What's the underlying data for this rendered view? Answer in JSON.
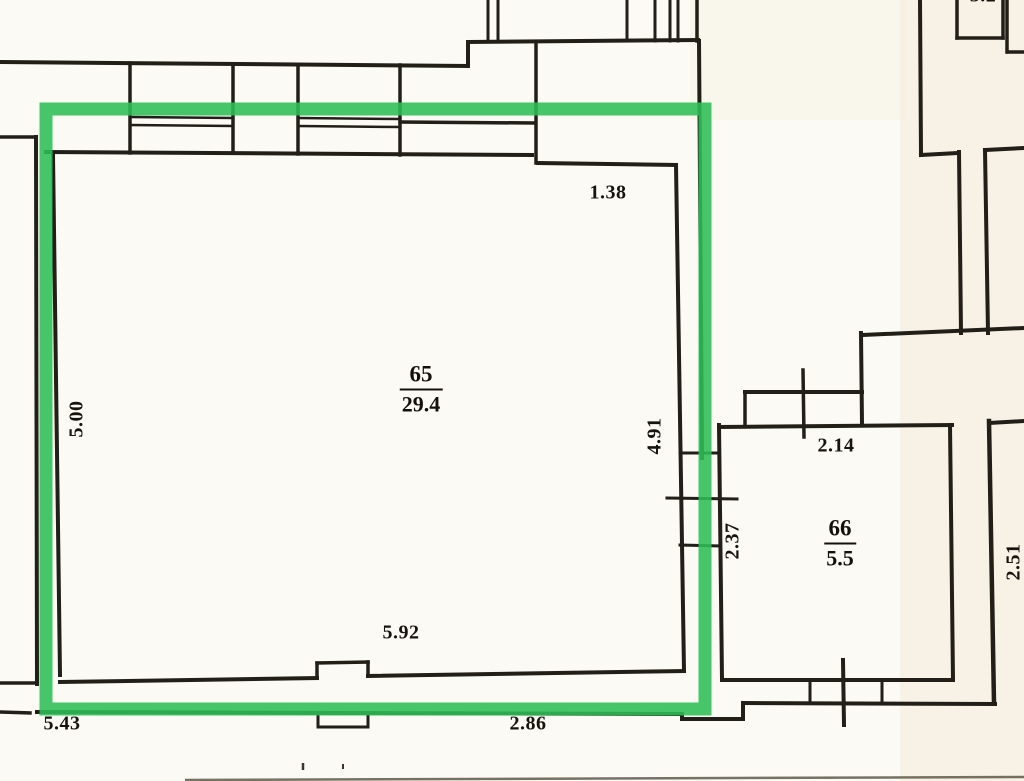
{
  "plan": {
    "kind": "scanned apartment floor plan with green highlight box",
    "highlight_color": "#2cbe55",
    "line_color": "#221f18",
    "paper_color": "#fbfaf4"
  },
  "rooms": [
    {
      "number": "65",
      "area": "29.4"
    },
    {
      "number": "66",
      "area": "5.5"
    }
  ],
  "dimensions": {
    "top_right": "1.38",
    "left_wall": "5.00",
    "right_wall": "4.91",
    "duct": "2.37",
    "room66_top": "2.14",
    "bottom_wall": "5.92",
    "bottom_left": "5.43",
    "bottom_right": "2.86",
    "far_right_wall": "2.51",
    "top_edge_partial": "3.2"
  }
}
